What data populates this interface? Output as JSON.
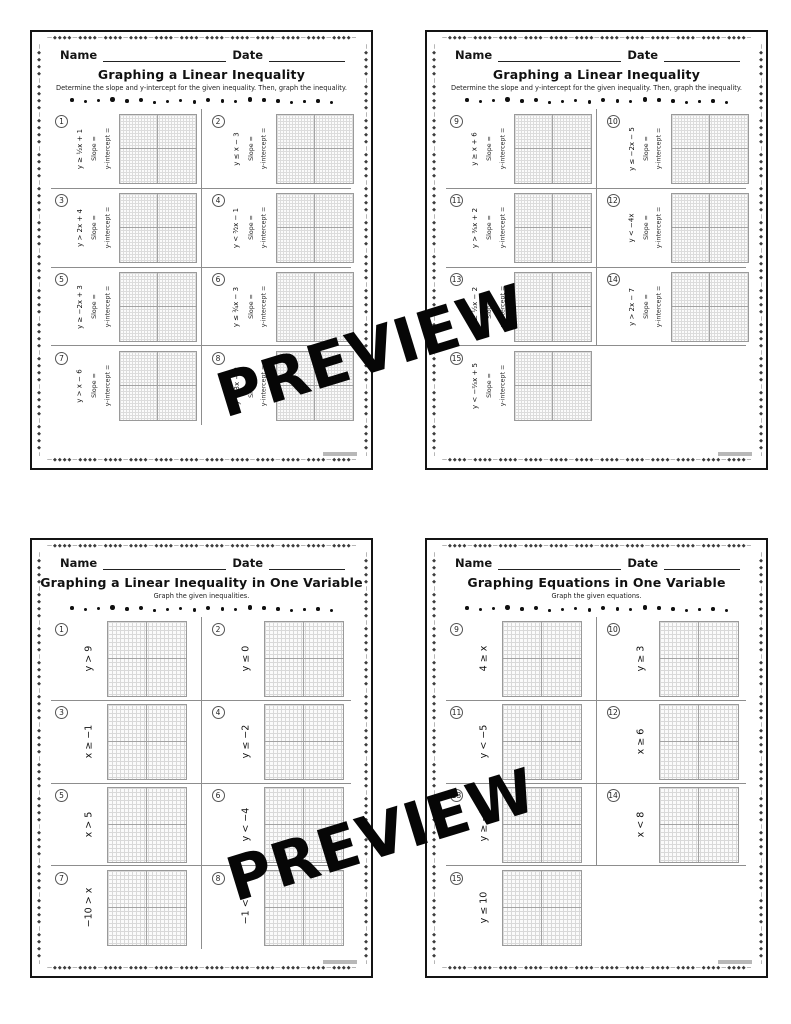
{
  "watermark": {
    "text": "PREVIEW"
  },
  "decor": {
    "border_unit": "◆◆◆◆",
    "dash": "—"
  },
  "shared": {
    "name_label": "Name",
    "date_label": "Date",
    "slope_label": "Slope =",
    "y_intercept_label": "y-intercept ="
  },
  "pages": [
    {
      "title": "Graphing a Linear Inequality",
      "subtitle": "Determine the slope and y-intercept for the given inequality. Then, graph the inequality.",
      "layout": "slope-intercept",
      "problems": [
        {
          "num": "1",
          "expr": "y ≥ ½x + 1"
        },
        {
          "num": "2",
          "expr": "y ≤ x − 3"
        },
        {
          "num": "3",
          "expr": "y > 2x + 4"
        },
        {
          "num": "4",
          "expr": "y < ³⁄₂x − 1"
        },
        {
          "num": "5",
          "expr": "y ≥ −2x + 3"
        },
        {
          "num": "6",
          "expr": "y ≤ ¾x − 3"
        },
        {
          "num": "7",
          "expr": "y > x − 6"
        },
        {
          "num": "8",
          "expr": "y < 3x − 2"
        }
      ]
    },
    {
      "title": "Graphing a Linear Inequality",
      "subtitle": "Determine the slope and y-intercept for the given inequality. Then, graph the inequality.",
      "layout": "slope-intercept",
      "problems": [
        {
          "num": "9",
          "expr": "y ≥ x + 6"
        },
        {
          "num": "10",
          "expr": "y ≤ −2x − 5"
        },
        {
          "num": "11",
          "expr": "y > ⅗x + 2"
        },
        {
          "num": "12",
          "expr": "y < −4x"
        },
        {
          "num": "13",
          "expr": "y ≥ ½x − 2"
        },
        {
          "num": "14",
          "expr": "y > 2x − 7"
        },
        {
          "num": "15",
          "expr": "y < −⅔x + 5"
        },
        null
      ]
    },
    {
      "title": "Graphing a Linear Inequality in One Variable",
      "subtitle": "Graph the given inequalities.",
      "layout": "one-variable",
      "problems": [
        {
          "num": "1",
          "expr": "y > 9"
        },
        {
          "num": "2",
          "expr": "y ≤ 0"
        },
        {
          "num": "3",
          "expr": "x ≥ −1"
        },
        {
          "num": "4",
          "expr": "y ≤ −2"
        },
        {
          "num": "5",
          "expr": "x > 5"
        },
        {
          "num": "6",
          "expr": "y < −4"
        },
        {
          "num": "7",
          "expr": "−10 > x"
        },
        {
          "num": "8",
          "expr": "−1 < y"
        }
      ]
    },
    {
      "title": "Graphing Equations in One Variable",
      "subtitle": "Graph the given equations.",
      "layout": "one-variable",
      "problems": [
        {
          "num": "9",
          "expr": "4 ≥ x"
        },
        {
          "num": "10",
          "expr": "y ≥ 3"
        },
        {
          "num": "11",
          "expr": "y < −5"
        },
        {
          "num": "12",
          "expr": "x ≥ 6"
        },
        {
          "num": "13",
          "expr": "y ≥ −7"
        },
        {
          "num": "14",
          "expr": "x < 8"
        },
        {
          "num": "15",
          "expr": "y ≤ 10"
        },
        null
      ]
    }
  ]
}
